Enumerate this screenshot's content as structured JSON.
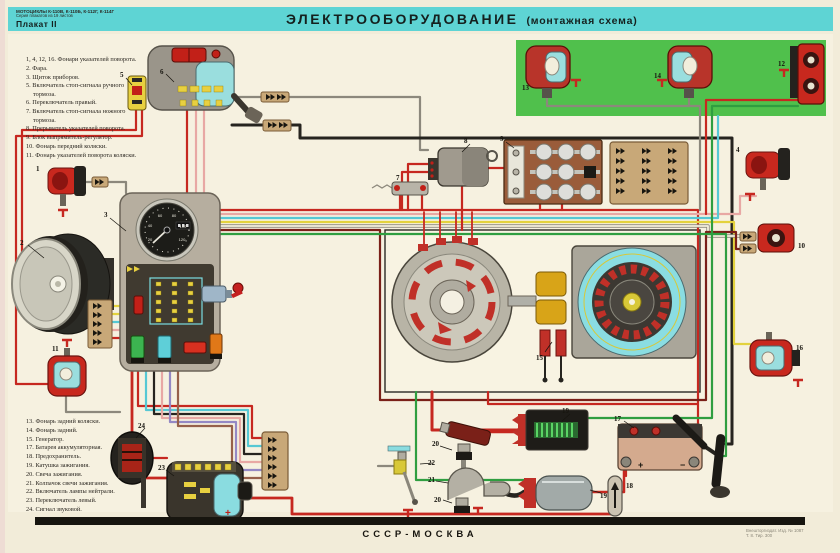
{
  "header": {
    "series_line1": "МОТОЦИКЛЫ К-110В, К-110Б, К-112Г, К-114Г",
    "series_line2": "Серия плакатов из 19 листов",
    "sheet": "Плакат II",
    "title": "ЭЛЕКТРООБОРУДОВАНИЕ",
    "subtitle": "(монтажная схема)"
  },
  "footer": {
    "center": "СССР-МОСКВА",
    "imprint_line1": "Внешторгиздат. Изд. № 1087",
    "imprint_line2": "Т. 8. Тир. 300"
  },
  "legend_top": {
    "items": [
      "1, 4, 12, 16. Фонари указателей поворота.",
      "2. Фара.",
      "3. Щиток приборов.",
      "5. Включатель стоп-сигнала ручного тормоза.",
      "6. Переключатель правый.",
      "7. Включатель стоп-сигнала ножного тормоза.",
      "8. Прерыватель указателей поворота.",
      "9. Блок выпрямитель-регулятор.",
      "10. Фонарь передний коляски.",
      "11. Фонарь указателей поворота коляски."
    ]
  },
  "legend_bottom": {
    "items": [
      "13. Фонарь задний коляски.",
      "14. Фонарь задний.",
      "15. Генератор.",
      "17. Батарея аккумуляторная.",
      "18. Предохранитель.",
      "19. Катушка зажигания.",
      "20. Свеча зажигания.",
      "21. Колпачок свечи зажигания.",
      "22. Включатель лампы нейтрали.",
      "23. Переключатель левый.",
      "24. Сигнал звуковой."
    ]
  },
  "callouts": [
    "1",
    "2",
    "3",
    "5",
    "6",
    "7",
    "8",
    "9",
    "13",
    "14",
    "12",
    "4",
    "10",
    "16",
    "15",
    "17",
    "18",
    "19",
    "19",
    "20",
    "20",
    "21",
    "22",
    "23",
    "24",
    "11"
  ],
  "speedometer": {
    "ticks": [
      "20",
      "40",
      "60",
      "80",
      "100",
      "120"
    ]
  },
  "battery": {
    "plus": "+",
    "minus": "−"
  },
  "colors": {
    "header_band": "#5ed4d4",
    "poster_bg": "#f2ecd9",
    "green_panel": "#50c04c",
    "wire_red": "#c62820",
    "wire_green": "#2f9e40",
    "wire_cyan": "#56c8d4",
    "wire_yellow": "#e3d23e",
    "wire_pink": "#e8a8a4",
    "wire_maroon": "#7a2018",
    "wire_purple": "#9488c4",
    "wire_brown": "#96604a",
    "wire_black": "#26241f"
  }
}
